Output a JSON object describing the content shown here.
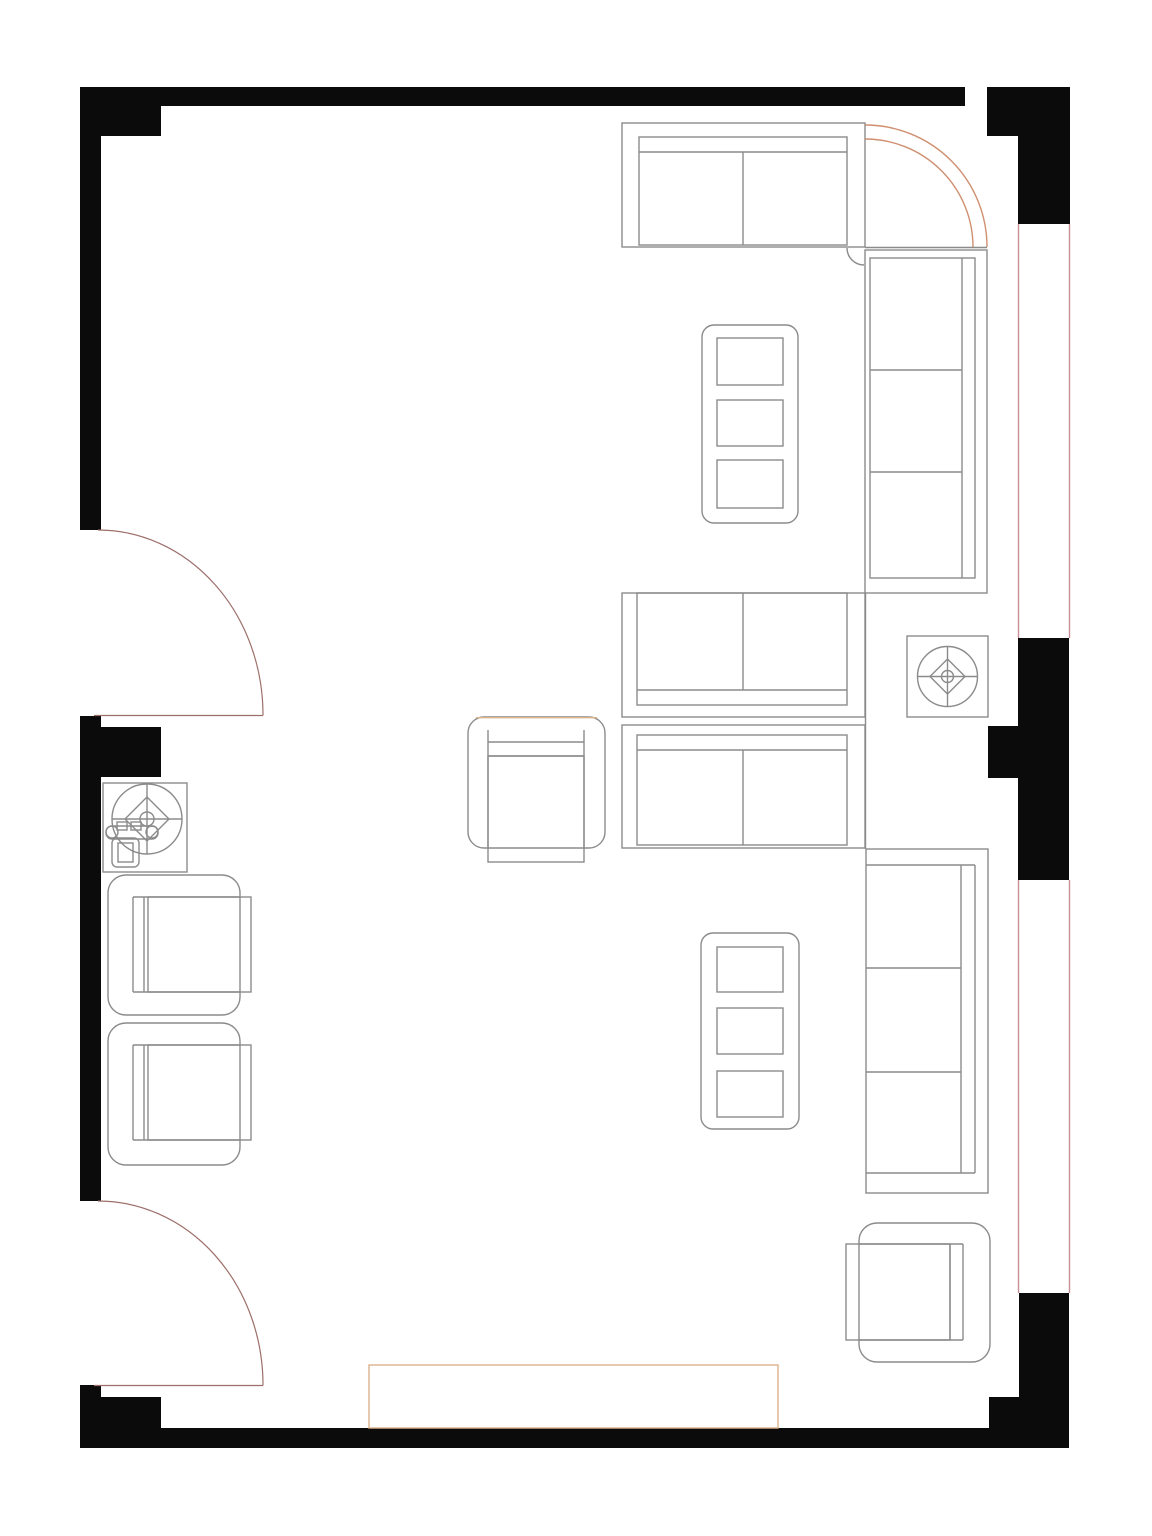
{
  "document": {
    "kind": "floor-plan",
    "subject": "living-room-furniture-layout"
  },
  "canvas": {
    "width": 1152,
    "height": 1536,
    "background": "#ffffff"
  },
  "colors": {
    "wall": "#0b0b0b",
    "furn": "#8b8b8b",
    "accent": "#cf8f70",
    "rug": "#ddb48c",
    "window": "#c58f95",
    "door": "#9c6f6a"
  },
  "walls": [
    {
      "name": "wall-top-band",
      "x": 80,
      "y": 87,
      "w": 885,
      "h": 19
    },
    {
      "name": "wall-top-left-block",
      "x": 80,
      "y": 87,
      "w": 81,
      "h": 49
    },
    {
      "name": "wall-left-upper-column",
      "x": 80,
      "y": 87,
      "w": 21,
      "h": 443
    },
    {
      "name": "wall-left-middle-column",
      "x": 80,
      "y": 716,
      "w": 21,
      "h": 485
    },
    {
      "name": "wall-left-middle-block",
      "x": 99,
      "y": 727,
      "w": 62,
      "h": 50
    },
    {
      "name": "wall-left-bottom-column",
      "x": 80,
      "y": 1385,
      "w": 21,
      "h": 63
    },
    {
      "name": "wall-bottom-left-step",
      "x": 99,
      "y": 1397,
      "w": 62,
      "h": 31
    },
    {
      "name": "wall-bottom-band",
      "x": 80,
      "y": 1428,
      "w": 989,
      "h": 20
    },
    {
      "name": "wall-bottom-right-step",
      "x": 989,
      "y": 1397,
      "w": 30,
      "h": 31
    },
    {
      "name": "wall-bottom-right-column",
      "x": 1019,
      "y": 1293,
      "w": 50,
      "h": 155
    },
    {
      "name": "wall-right-middle-block",
      "x": 1018,
      "y": 638,
      "w": 51,
      "h": 242
    },
    {
      "name": "wall-right-middle-pier",
      "x": 988,
      "y": 726,
      "w": 30,
      "h": 52
    },
    {
      "name": "wall-top-right-block",
      "x": 987,
      "y": 87,
      "w": 83,
      "h": 49
    },
    {
      "name": "wall-top-right-column",
      "x": 1018,
      "y": 136,
      "w": 52,
      "h": 88
    }
  ],
  "windows": [
    {
      "name": "window-right-upper-inner-line",
      "x1": 1018.5,
      "y1": 224,
      "x2": 1018.5,
      "y2": 638
    },
    {
      "name": "window-right-upper-outer-line",
      "x1": 1069.5,
      "y1": 224,
      "x2": 1069.5,
      "y2": 638
    },
    {
      "name": "window-right-lower-inner-line",
      "x1": 1018.5,
      "y1": 880,
      "x2": 1018.5,
      "y2": 1293
    },
    {
      "name": "window-right-lower-outer-line",
      "x1": 1069.5,
      "y1": 880,
      "x2": 1069.5,
      "y2": 1293
    }
  ],
  "doors": [
    {
      "name": "door-left-upper",
      "leaf": {
        "x1": 94,
        "y1": 715.5,
        "x2": 263,
        "y2": 715.5
      },
      "arc": "M 98 530 A 165 185 0 0 1 263 715.5"
    },
    {
      "name": "door-left-lower",
      "leaf": {
        "x1": 94,
        "y1": 1385.5,
        "x2": 263,
        "y2": 1385.5
      },
      "arc": "M 98 1201 A 165 184 0 0 1 263 1385.5"
    }
  ],
  "furniture": [
    {
      "name": "sofa-top-two-seat",
      "shapes": [
        {
          "t": "rect",
          "x": 622,
          "y": 123,
          "w": 243,
          "h": 124
        },
        {
          "t": "rect",
          "x": 639,
          "y": 137,
          "w": 208,
          "h": 108
        },
        {
          "t": "line",
          "x1": 639,
          "y1": 152,
          "x2": 847,
          "y2": 152
        },
        {
          "t": "line",
          "x1": 743,
          "y1": 152,
          "x2": 743,
          "y2": 245
        }
      ]
    },
    {
      "name": "corner-sectional-curve",
      "shapes": [
        {
          "t": "path",
          "d": "M 865 125 A 122 122 0 0 1 987 247",
          "s": "accent"
        },
        {
          "t": "path",
          "d": "M 865 139 A 108 108 0 0 1 973 247",
          "s": "accent"
        },
        {
          "t": "line",
          "x1": 865,
          "y1": 247.5,
          "x2": 987,
          "y2": 247.5
        },
        {
          "t": "path",
          "d": "M 847 248 A 17 17 0 0 0 864 265"
        }
      ]
    },
    {
      "name": "sofa-right-upper-three-seat",
      "shapes": [
        {
          "t": "rect",
          "x": 865,
          "y": 250,
          "w": 122,
          "h": 343
        },
        {
          "t": "rect",
          "x": 870,
          "y": 258,
          "w": 105,
          "h": 320
        },
        {
          "t": "line",
          "x1": 962,
          "y1": 258,
          "x2": 962,
          "y2": 578
        },
        {
          "t": "line",
          "x1": 870,
          "y1": 370,
          "x2": 962,
          "y2": 370
        },
        {
          "t": "line",
          "x1": 870,
          "y1": 472,
          "x2": 962,
          "y2": 472
        }
      ]
    },
    {
      "name": "coffee-table-upper",
      "shapes": [
        {
          "t": "rect",
          "x": 702,
          "y": 325,
          "w": 96,
          "h": 198,
          "r": 12
        },
        {
          "t": "rect",
          "x": 717,
          "y": 338,
          "w": 66,
          "h": 47
        },
        {
          "t": "rect",
          "x": 717,
          "y": 400,
          "w": 66,
          "h": 46
        },
        {
          "t": "rect",
          "x": 717,
          "y": 460,
          "w": 66,
          "h": 48
        }
      ]
    },
    {
      "name": "loveseat-middle-upper",
      "shapes": [
        {
          "t": "rect",
          "x": 622,
          "y": 593,
          "w": 243,
          "h": 124
        },
        {
          "t": "rect",
          "x": 637,
          "y": 593,
          "w": 210,
          "h": 112
        },
        {
          "t": "line",
          "x1": 637,
          "y1": 690,
          "x2": 847,
          "y2": 690
        },
        {
          "t": "line",
          "x1": 743,
          "y1": 593,
          "x2": 743,
          "y2": 690
        }
      ]
    },
    {
      "name": "loveseat-middle-lower",
      "shapes": [
        {
          "t": "rect",
          "x": 622,
          "y": 725,
          "w": 243,
          "h": 123
        },
        {
          "t": "rect",
          "x": 637,
          "y": 735,
          "w": 210,
          "h": 110
        },
        {
          "t": "line",
          "x1": 637,
          "y1": 750,
          "x2": 847,
          "y2": 750
        },
        {
          "t": "line",
          "x1": 743,
          "y1": 750,
          "x2": 743,
          "y2": 845
        }
      ]
    },
    {
      "name": "sectional-spine-line",
      "shapes": [
        {
          "t": "line",
          "x1": 865.5,
          "y1": 593,
          "x2": 865.5,
          "y2": 849
        }
      ]
    },
    {
      "name": "armchair-center",
      "shapes": [
        {
          "t": "rect",
          "x": 468,
          "y": 717,
          "w": 137,
          "h": 131,
          "r": 16
        },
        {
          "t": "line",
          "x1": 476,
          "y1": 717.7,
          "x2": 597,
          "y2": 717.7,
          "s": "rug"
        },
        {
          "t": "line",
          "x1": 488,
          "y1": 742,
          "x2": 584,
          "y2": 742
        },
        {
          "t": "line",
          "x1": 488,
          "y1": 756,
          "x2": 584,
          "y2": 756
        },
        {
          "t": "line",
          "x1": 488,
          "y1": 730,
          "x2": 488,
          "y2": 848
        },
        {
          "t": "line",
          "x1": 584,
          "y1": 730,
          "x2": 584,
          "y2": 848
        },
        {
          "t": "rect",
          "x": 488,
          "y": 756,
          "w": 96,
          "h": 106
        }
      ]
    },
    {
      "name": "sofa-right-lower-three-seat",
      "shapes": [
        {
          "t": "rect",
          "x": 866,
          "y": 849,
          "w": 122,
          "h": 344
        },
        {
          "t": "line",
          "x1": 866,
          "y1": 865,
          "x2": 975,
          "y2": 865
        },
        {
          "t": "line",
          "x1": 866,
          "y1": 1173,
          "x2": 975,
          "y2": 1173
        },
        {
          "t": "line",
          "x1": 961,
          "y1": 865,
          "x2": 961,
          "y2": 1173
        },
        {
          "t": "line",
          "x1": 975,
          "y1": 865,
          "x2": 975,
          "y2": 1173
        },
        {
          "t": "line",
          "x1": 866,
          "y1": 968,
          "x2": 961,
          "y2": 968
        },
        {
          "t": "line",
          "x1": 866,
          "y1": 1072,
          "x2": 961,
          "y2": 1072
        }
      ]
    },
    {
      "name": "coffee-table-lower",
      "shapes": [
        {
          "t": "rect",
          "x": 701,
          "y": 933,
          "w": 98,
          "h": 196,
          "r": 12
        },
        {
          "t": "rect",
          "x": 717,
          "y": 947,
          "w": 66,
          "h": 45
        },
        {
          "t": "rect",
          "x": 717,
          "y": 1008,
          "w": 66,
          "h": 46
        },
        {
          "t": "rect",
          "x": 717,
          "y": 1071,
          "w": 66,
          "h": 46
        }
      ]
    },
    {
      "name": "armchair-bottom-right",
      "shapes": [
        {
          "t": "rect",
          "x": 859,
          "y": 1223,
          "w": 131,
          "h": 139,
          "r": 18
        },
        {
          "t": "line",
          "x1": 859,
          "y1": 1244,
          "x2": 963,
          "y2": 1244
        },
        {
          "t": "line",
          "x1": 859,
          "y1": 1340,
          "x2": 963,
          "y2": 1340
        },
        {
          "t": "line",
          "x1": 950,
          "y1": 1244,
          "x2": 950,
          "y2": 1340
        },
        {
          "t": "line",
          "x1": 963,
          "y1": 1244,
          "x2": 963,
          "y2": 1340
        },
        {
          "t": "rect",
          "x": 846,
          "y": 1244,
          "w": 104,
          "h": 96
        }
      ]
    },
    {
      "name": "armchair-left-upper",
      "shapes": [
        {
          "t": "rect",
          "x": 108,
          "y": 875,
          "w": 132,
          "h": 140,
          "r": 18
        },
        {
          "t": "line",
          "x1": 133,
          "y1": 897,
          "x2": 240,
          "y2": 897
        },
        {
          "t": "line",
          "x1": 133,
          "y1": 992,
          "x2": 240,
          "y2": 992
        },
        {
          "t": "line",
          "x1": 133,
          "y1": 897,
          "x2": 133,
          "y2": 992
        },
        {
          "t": "line",
          "x1": 144,
          "y1": 897,
          "x2": 144,
          "y2": 992
        },
        {
          "t": "rect",
          "x": 148,
          "y": 897,
          "w": 103,
          "h": 95
        }
      ]
    },
    {
      "name": "armchair-left-lower",
      "shapes": [
        {
          "t": "rect",
          "x": 108,
          "y": 1023,
          "w": 132,
          "h": 142,
          "r": 18
        },
        {
          "t": "line",
          "x1": 133,
          "y1": 1045,
          "x2": 240,
          "y2": 1045
        },
        {
          "t": "line",
          "x1": 133,
          "y1": 1140,
          "x2": 240,
          "y2": 1140
        },
        {
          "t": "line",
          "x1": 133,
          "y1": 1045,
          "x2": 133,
          "y2": 1140
        },
        {
          "t": "line",
          "x1": 144,
          "y1": 1045,
          "x2": 144,
          "y2": 1140
        },
        {
          "t": "rect",
          "x": 148,
          "y": 1045,
          "w": 103,
          "h": 95
        }
      ]
    },
    {
      "name": "ceiling-fan-right",
      "shapes": [
        {
          "t": "rect",
          "x": 907,
          "y": 636,
          "w": 81,
          "h": 81
        },
        {
          "t": "circle",
          "cx": 947.5,
          "cy": 676.5,
          "r": 30
        },
        {
          "t": "line",
          "x1": 917,
          "y1": 676.5,
          "x2": 978,
          "y2": 676.5
        },
        {
          "t": "line",
          "x1": 947.5,
          "y1": 646,
          "x2": 947.5,
          "y2": 707
        },
        {
          "t": "path",
          "d": "M 947.5 659 L 965 676.5 L 947.5 694 L 930 676.5 Z"
        },
        {
          "t": "circle",
          "cx": 947.5,
          "cy": 676.5,
          "r": 6
        }
      ]
    },
    {
      "name": "ceiling-fan-left",
      "shapes": [
        {
          "t": "rect",
          "x": 103,
          "y": 783,
          "w": 84,
          "h": 89
        },
        {
          "t": "circle",
          "cx": 147,
          "cy": 819,
          "r": 35
        },
        {
          "t": "line",
          "x1": 112,
          "y1": 819,
          "x2": 182,
          "y2": 819
        },
        {
          "t": "line",
          "x1": 147,
          "y1": 784,
          "x2": 147,
          "y2": 854
        },
        {
          "t": "path",
          "d": "M 147 797 L 169 819 L 147 841 L 125 819 Z"
        },
        {
          "t": "circle",
          "cx": 147,
          "cy": 819,
          "r": 7
        }
      ]
    },
    {
      "name": "small-chair-symbol",
      "shapes": [
        {
          "t": "circle",
          "cx": 112,
          "cy": 832,
          "r": 6
        },
        {
          "t": "circle",
          "cx": 152,
          "cy": 832,
          "r": 6
        },
        {
          "t": "rect",
          "x": 106,
          "y": 826,
          "w": 52,
          "h": 13,
          "r": 6
        },
        {
          "t": "rect",
          "x": 117,
          "y": 822,
          "w": 10,
          "h": 8
        },
        {
          "t": "rect",
          "x": 131,
          "y": 822,
          "w": 10,
          "h": 8
        },
        {
          "t": "rect",
          "x": 112,
          "y": 838,
          "w": 27,
          "h": 29,
          "r": 5
        },
        {
          "t": "rect",
          "x": 118,
          "y": 843,
          "w": 15,
          "h": 19
        }
      ]
    },
    {
      "name": "rug-bottom",
      "shapes": [
        {
          "t": "rect",
          "x": 369,
          "y": 1365,
          "w": 409,
          "h": 63,
          "s": "rug"
        }
      ]
    }
  ]
}
